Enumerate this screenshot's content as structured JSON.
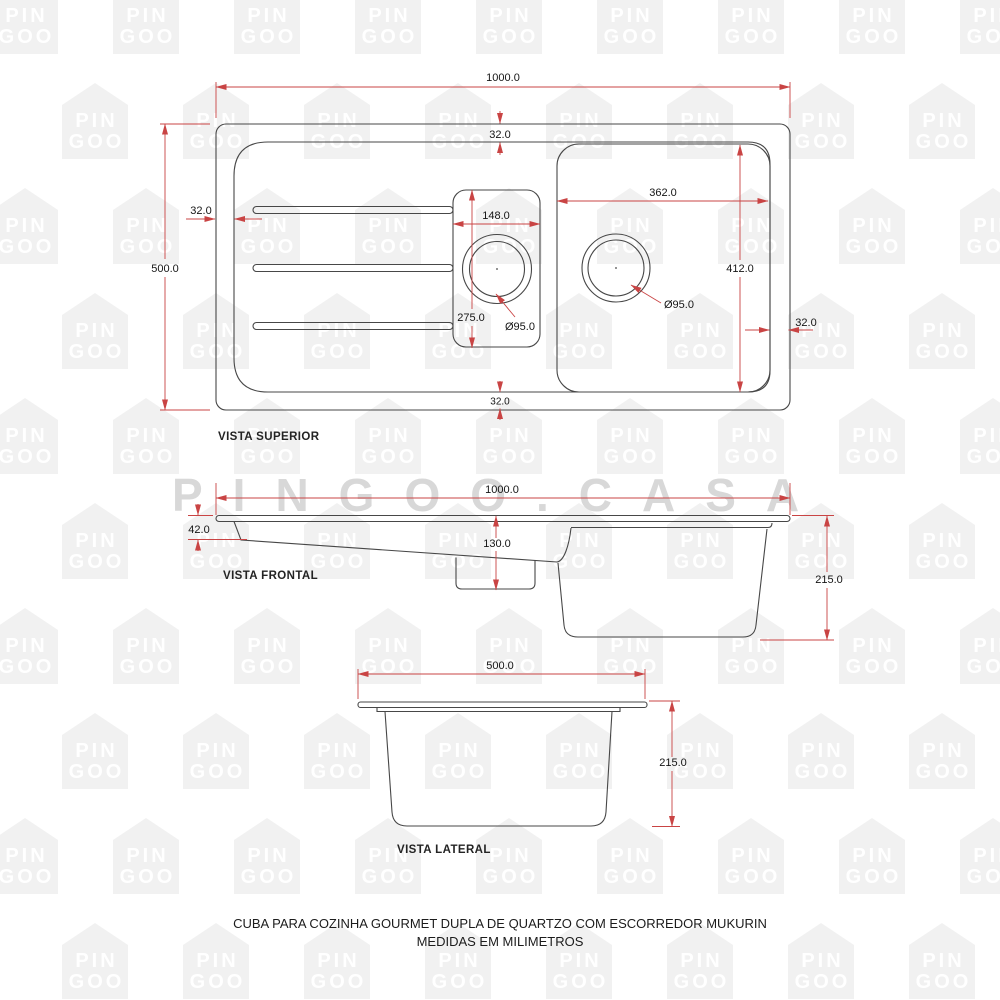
{
  "watermark": {
    "tile_line1": "PIN",
    "tile_line2": "GOO",
    "brand": "PINGOO.CASA"
  },
  "views": {
    "top": {
      "label": "VISTA SUPERIOR",
      "dim_width": "1000.0",
      "dim_height": "500.0",
      "dim_inset_top": "32.0",
      "dim_inset_left": "32.0",
      "dim_inset_right": "32.0",
      "dim_inset_bottom": "32.0",
      "dim_small_bowl_width": "148.0",
      "dim_small_bowl_length": "275.0",
      "dim_small_drain": "Ø95.0",
      "dim_large_bowl_width": "362.0",
      "dim_large_bowl_length": "412.0",
      "dim_large_drain": "Ø95.0"
    },
    "front": {
      "label": "VISTA FRONTAL",
      "dim_width": "1000.0",
      "dim_rim_height": "42.0",
      "dim_small_bowl_depth": "130.0",
      "dim_total_depth": "215.0"
    },
    "side": {
      "label": "VISTA LATERAL",
      "dim_width": "500.0",
      "dim_total_depth": "215.0"
    }
  },
  "caption": {
    "line1": "CUBA PARA COZINHA GOURMET DUPLA DE QUARTZO COM ESCORREDOR MUKURIN",
    "line2": "MEDIDAS EM MILIMETROS"
  },
  "colors": {
    "dimension": "#c94444",
    "drawing": "#474747",
    "tile": "#f1f1f1",
    "brand": "#d8d8d8"
  }
}
